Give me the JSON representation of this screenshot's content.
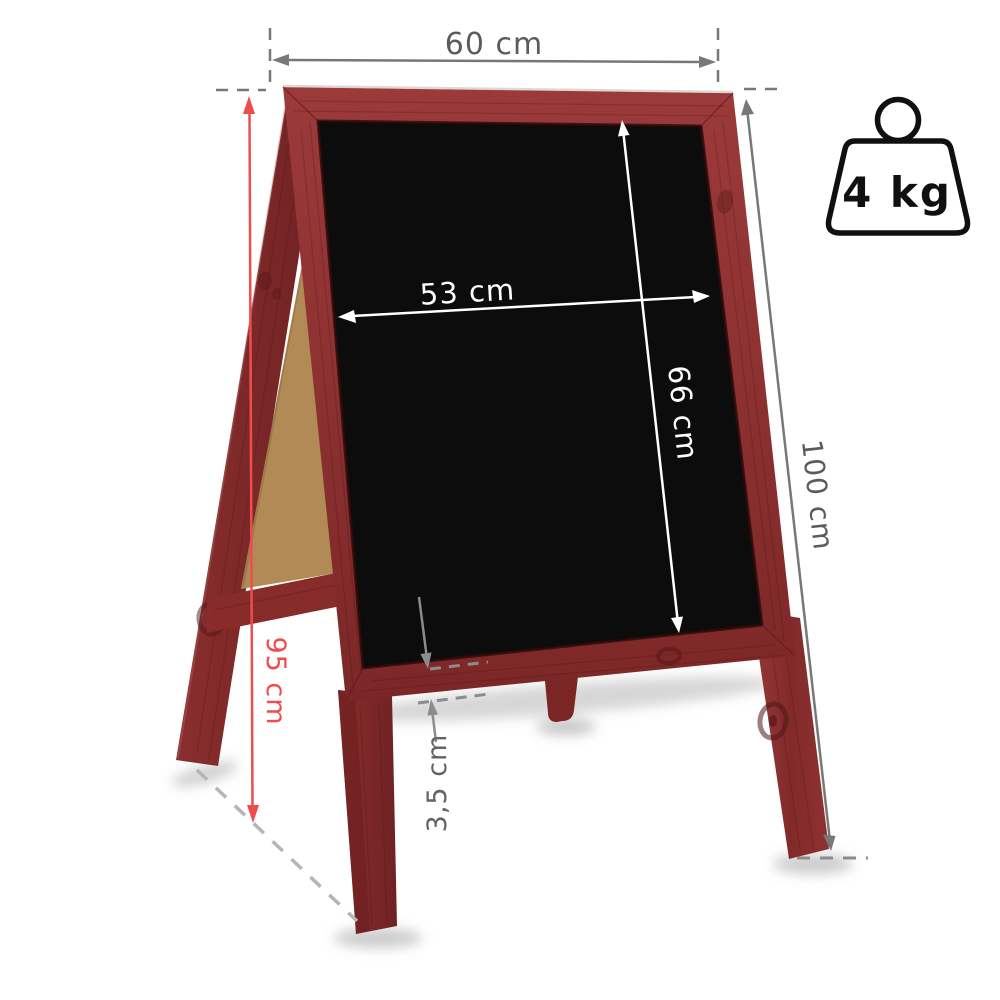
{
  "page": {
    "background": "#ffffff",
    "title": "a-frame-chalkboard-dimension-diagram"
  },
  "product": {
    "type": "a-frame-chalkboard",
    "frame_color": "#8e2f2f",
    "board_color": "#0c0c0c",
    "back_panel_color": "#b18a55"
  },
  "dimensions": {
    "outer_width": "60 cm",
    "writable_width": "53 cm",
    "writable_height": "66 cm",
    "total_height": "100 cm",
    "side_height": "95 cm",
    "frame_thickness": "3,5 cm"
  },
  "weight": {
    "label": "4 kg"
  },
  "annotation_colors": {
    "neutral_gray": "#6a6a6a",
    "text_gray": "#5b5b5b",
    "red": "#ee4d4d",
    "white": "#ffffff",
    "ground_dash": "#b5b5b5"
  }
}
